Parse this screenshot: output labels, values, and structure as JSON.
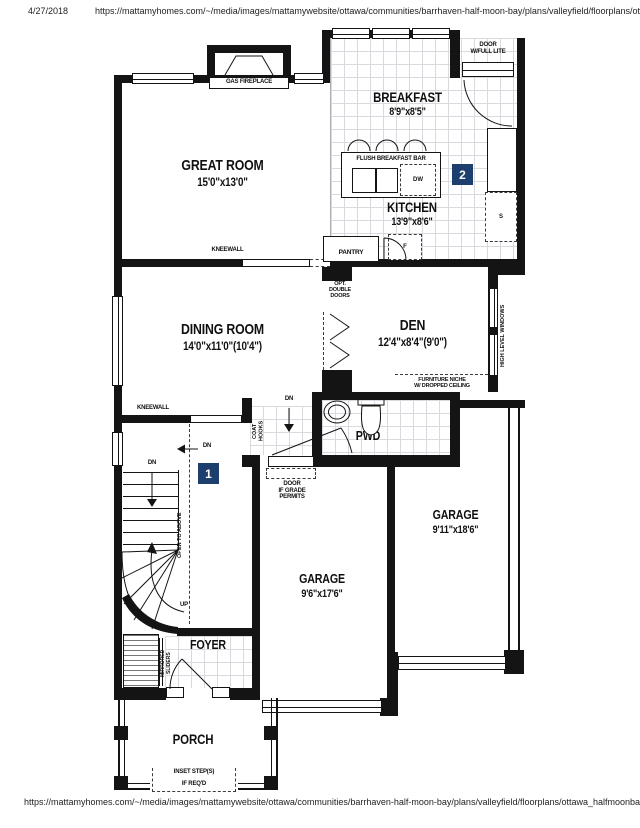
{
  "page": {
    "date": "4/27/2018",
    "header_url": "https://mattamyhomes.com/~/media/images/mattamywebsite/ottawa/communities/barrhaven-half-moon-bay/plans/valleyfield/floorplans/ot...",
    "footer_url": "https://mattamyhomes.com/~/media/images/mattamywebsite/ottawa/communities/barrhaven-half-moon-bay/plans/valleyfield/floorplans/ottawa_halfmoonbay_valleyfiel"
  },
  "colors": {
    "badge": "#1d3f6e",
    "wall": "#141414",
    "tile_line": "#d7dade"
  },
  "rooms": {
    "great_room": {
      "name": "GREAT ROOM",
      "dims": "15'0\"x13'0\""
    },
    "breakfast": {
      "name": "BREAKFAST",
      "dims": "8'9\"x8'5\""
    },
    "kitchen": {
      "name": "KITCHEN",
      "dims": "13'9\"x8'6\""
    },
    "dining": {
      "name": "DINING ROOM",
      "dims": "14'0\"x11'0\"(10'4\")"
    },
    "den": {
      "name": "DEN",
      "dims": "12'4\"x8'4\"(9'0\")"
    },
    "pwd": {
      "name": "PWD"
    },
    "garage_right": {
      "name": "GARAGE",
      "dims": "9'11\"x18'6\""
    },
    "garage_left": {
      "name": "GARAGE",
      "dims": "9'6\"x17'6\""
    },
    "foyer": {
      "name": "FOYER"
    },
    "porch": {
      "name": "PORCH"
    }
  },
  "labels": {
    "gas_fireplace": "GAS FIREPLACE",
    "door_full_lite": "DOOR\nW/FULL LITE",
    "flush_breakfast_bar": "FLUSH BREAKFAST BAR",
    "dw": "DW",
    "fridge": "F",
    "stove": "S",
    "pantry": "PANTRY",
    "kneewall": "KNEEWALL",
    "opt_double_doors": "OPT.\nDOUBLE\nDOORS",
    "high_level_windows": "HIGH LEVEL WINDOWS",
    "furniture_niche": "FURNITURE NICHE\nW/ DROPPED CEILING",
    "coat_hooks": "COAT\nHOOKS",
    "dn": "DN",
    "up": "UP",
    "open_to_above": "OPEN TO ABOVE",
    "door_if_grade": "DOOR\nIF GRADE\nPERMITS",
    "mirrored_sliders": "MIRRORED\nSLIDERS",
    "inset_steps": "INSET STEP(S)",
    "if_reqd": "IF REQ'D",
    "badge_1": "1",
    "badge_2": "2"
  }
}
